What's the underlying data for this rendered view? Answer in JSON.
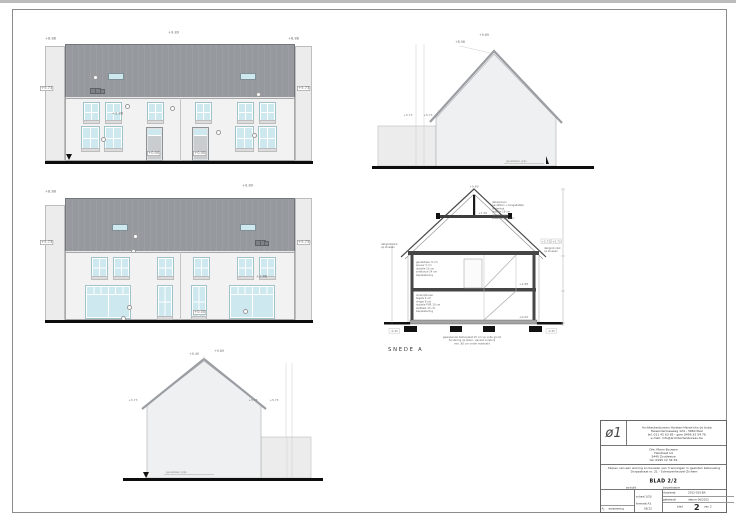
{
  "colors": {
    "roof": "#96999d",
    "glass": "#cde9ef",
    "wall": "#f2f2f2",
    "ground": "#0d0d0d",
    "slab": "#454545"
  },
  "front": {
    "ridge": "+9.89",
    "top_left": "+8.88",
    "top_right": "+8.88",
    "eaves_left": "+5.73",
    "eaves_right": "+5.73",
    "mid": "+2.88",
    "door_left": "+0.00",
    "door_right": "+0.00"
  },
  "rear": {
    "ridge": "+9.89",
    "top_left": "+8.88",
    "eaves_left": "+5.73",
    "eaves_right": "+5.73",
    "mid": "+2.88",
    "door": "+0.00"
  },
  "side_right": {
    "ridge": "+9.89",
    "sub_ridge": "+8.98",
    "eaves_a": "+5.73",
    "eaves_b": "+5.73",
    "note": "gevelsteen grijs"
  },
  "side_left": {
    "ridge": "+9.89",
    "sub_ridge": "+9.49",
    "eaves_left": "+5.73",
    "eaves_a": "+5.73",
    "eaves_b": "+5.73",
    "note": "gevelsteen grijs"
  },
  "section": {
    "title": "SNEDE A",
    "ridge": "+9.89",
    "collar": "+7.46",
    "floor": "+2.88",
    "ground": "+0.00",
    "eaves_a": "+5.73",
    "eaves_b": "+5.73",
    "found_left": "-0.45",
    "found_right": "-0.45",
    "roof_note": [
      "dakpannen",
      "panlatten + tengellatten",
      "onderdak",
      "isolatie 18 cm",
      "dampscherm",
      "afwerking gyproc"
    ],
    "wall_note": [
      "gevelsteen 9 cm",
      "spouw 3 cm",
      "isolatie 10 cm",
      "snelbouw 14 cm",
      "bepleistering"
    ],
    "floor_note": [
      "vloeropbouw:",
      "tegels 2 cm",
      "chape 8 cm",
      "isolatie PUR 10 cm",
      "welfsels 13 cm",
      "bepleistering"
    ],
    "eaves_note_left": [
      "dakgoot zink",
      "op klossen"
    ],
    "eaves_note_right": [
      "dakgoot zink",
      "op klossen"
    ],
    "foundation_note": [
      "gewapende betonplaat 15 cm op volle grond",
      "fundering op staal - aanzet vorstvrij",
      "min. 80 cm onder maaiveld"
    ]
  },
  "titleblock": {
    "logo": "ø1",
    "architect": [
      "Architectenbureau Horsten-Hendrickx bv bvba",
      "Tessenderloseweg 124 - 3980 Paal",
      "tel. 011 42 63 85 - gsm 0496 32 54 76",
      "e-mail: info@architectenbureau.be"
    ],
    "client": [
      "Dhr. Mario Bouwen",
      "Heistraat 14",
      "3440 Zoutleeuw",
      "tel. 0495 12 34 56"
    ],
    "project": [
      "Slopen van een woning en bouwen van 3 woningen in gesloten bebouwing",
      "Dorpsstraat nr. 21 - Scherpenheuvel-Zichem"
    ],
    "sheet_label": "BLAD 2/2",
    "sheet_sub_left": "as-built",
    "sheet_sub_right": "bouwdossier",
    "rev_id": "A",
    "rev_desc": "aanpassing",
    "rev_date": "05/12",
    "scale": "schaal 1/50",
    "format": "formaat A3",
    "field1_label": "dossiernr.",
    "field1_value": "2012-015-BA",
    "field2_label": "getekend",
    "field2_value": "datum 06/2012",
    "blad_word": "blad",
    "blad_num": "2",
    "blad_of": "van 2"
  }
}
